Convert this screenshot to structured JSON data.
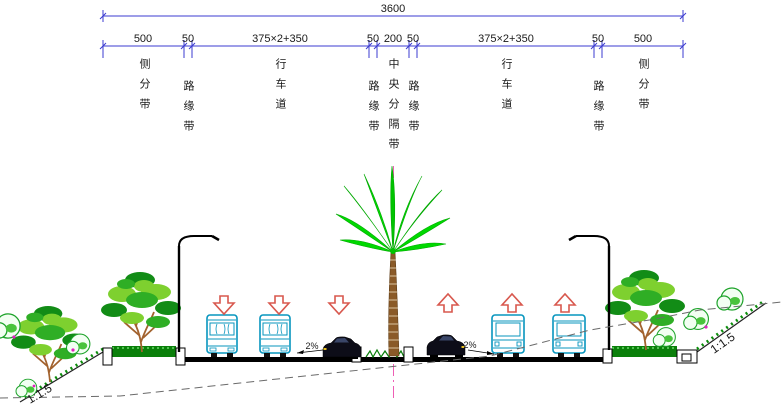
{
  "drawing": {
    "total_dimension": "3600",
    "segments": [
      {
        "value": "500",
        "label": "侧分带"
      },
      {
        "value": "50",
        "label": "路缘带"
      },
      {
        "value": "375×2+350",
        "label": "行车道"
      },
      {
        "value": "50",
        "label": "路缘带"
      },
      {
        "value": "200",
        "label": "中央分隔带"
      },
      {
        "value": "50",
        "label": "路缘带"
      },
      {
        "value": "375×2+350",
        "label": "行车道"
      },
      {
        "value": "50",
        "label": "路缘带"
      },
      {
        "value": "500",
        "label": "侧分带"
      }
    ],
    "slope_labels": {
      "left": "1:1.5",
      "right": "1:1.5"
    },
    "cross_slope_labels": {
      "left": "2%",
      "right": "2%"
    },
    "colors": {
      "dimension_line": "#3b3bd0",
      "text": "#1a1a1a",
      "road": "#000000",
      "bus": "#0795be",
      "arrow": "#d8584e",
      "centerline": "#ee5fb5",
      "palm_frond": "#00d800",
      "palm_trunk": "#8a5a28",
      "tree_light": "#7ed02f",
      "tree_dark": "#128c16",
      "grass": "#0a7f0a",
      "ground_dash": "#6a6a6a"
    }
  }
}
